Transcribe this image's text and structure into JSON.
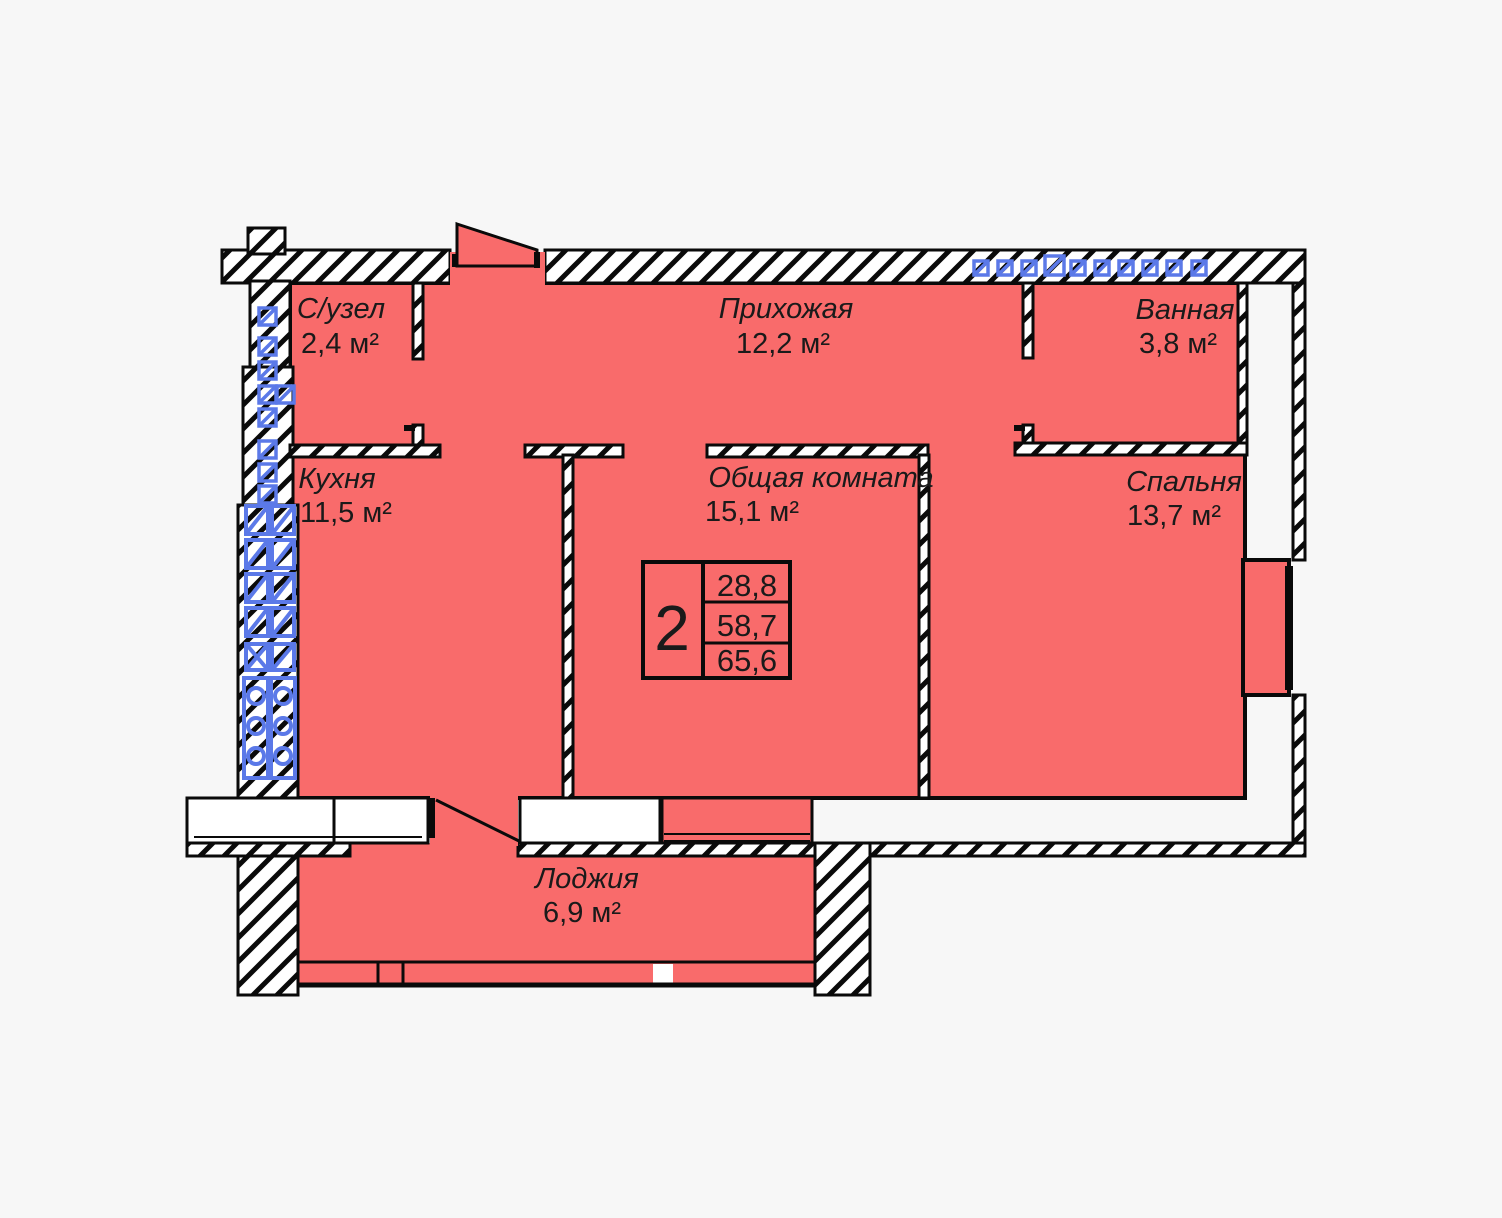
{
  "title": "План 2-комнатной квартиры",
  "rooms": [
    {
      "id": "szuel",
      "name": "С/узел",
      "area": "2,4 м²"
    },
    {
      "id": "prihozhaya",
      "name": "Прихожая",
      "area": "12,2 м²"
    },
    {
      "id": "vannaya",
      "name": "Ванная",
      "area": "3,8 м²"
    },
    {
      "id": "kuhnya",
      "name": "Кухня",
      "area": "11,5 м²"
    },
    {
      "id": "obshchaya",
      "name": "Общая комната",
      "area": "15,1 м²"
    },
    {
      "id": "spalnya",
      "name": "Спальня",
      "area": "13,7 м²"
    },
    {
      "id": "lodzhiya",
      "name": "Лоджия",
      "area": "6,9 м²"
    }
  ],
  "legend": {
    "rooms_count": "2",
    "living_area": "28,8",
    "usable_area": "58,7",
    "total_area": "65,6"
  },
  "icons": {
    "vent_square": "ventilation-grate-symbol",
    "vent_shaft": "ventilation-shaft-with-ducts-symbol"
  },
  "colors": {
    "floor": "#f96b6b",
    "background": "#f7f7f7",
    "line": "#0a0a0a",
    "vent": "#5b79e8"
  }
}
